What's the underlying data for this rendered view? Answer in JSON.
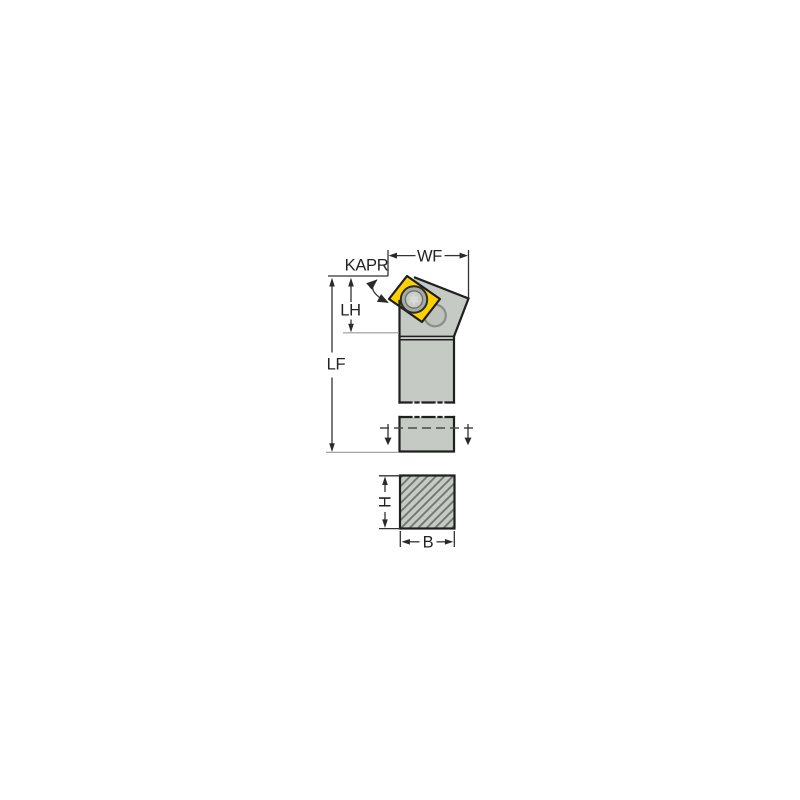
{
  "figure": {
    "title": "tool-holder-dimension-drawing",
    "description": "Technical line drawing of a lathe turning tool holder with yellow diamond insert: side view with dimensions and hatched shank cross-section",
    "labels": {
      "kapr": "KAPR",
      "wf": "WF",
      "lh": "LH",
      "lf": "LF",
      "h": "H",
      "b": "B"
    },
    "colors": {
      "insert": "#fdd000",
      "steel": "#c5cac4",
      "outline": "#1f1f1f",
      "dimension": "#333333",
      "hatch": "#6e726e",
      "thin": "#9a9a9a",
      "text": "#232323",
      "background": "#ffffff"
    }
  }
}
